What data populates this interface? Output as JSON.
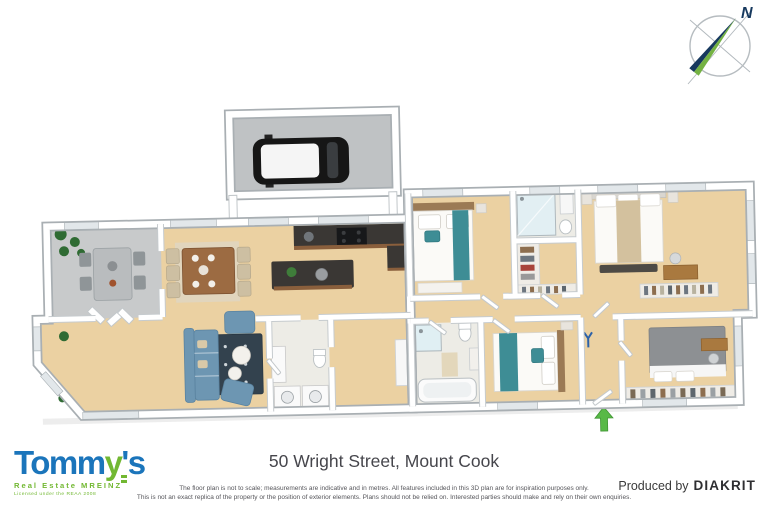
{
  "compass": {
    "north_label": "N"
  },
  "plan": {
    "colors": {
      "floor_wood": "#ebd1a2",
      "deck_gray": "#c8cacb",
      "garage_floor": "#bfc2c4",
      "car_black": "#161616",
      "counter_dark": "#3a3734",
      "counter_wood": "#8a5f3c",
      "sofa_blue": "#6d96b2",
      "rug_navy": "#33424e",
      "bed_teal": "#3e8d95",
      "bed4_gray": "#8d9093",
      "master_throw": "#d3c19e",
      "headboard_wood": "#9b7a55",
      "plant_green": "#2f6b33",
      "entry_arrow_green": "#58b947"
    }
  },
  "footer": {
    "address": "50 Wright Street, Mount Cook",
    "disclaimer_line1": "The floor plan is not to scale; measurements are indicative and in metres. All features included in this 3D plan are for inspiration purposes only.",
    "disclaimer_line2": "This is not an exact replica of the property or the position of exterior elements. Plans should not be relied on. Interested parties should make and rely on their own enquiries.",
    "produced_by_label": "Produced by",
    "producer_name": "DIAKRIT"
  },
  "logo": {
    "brand_prefix": "Tomm",
    "brand_key_letter": "y",
    "brand_suffix": "'s",
    "tagline": "Real Estate MREINZ",
    "license": "Licensed under the REAA 2008",
    "brand_blue": "#1b75bb",
    "brand_green": "#72b832"
  }
}
